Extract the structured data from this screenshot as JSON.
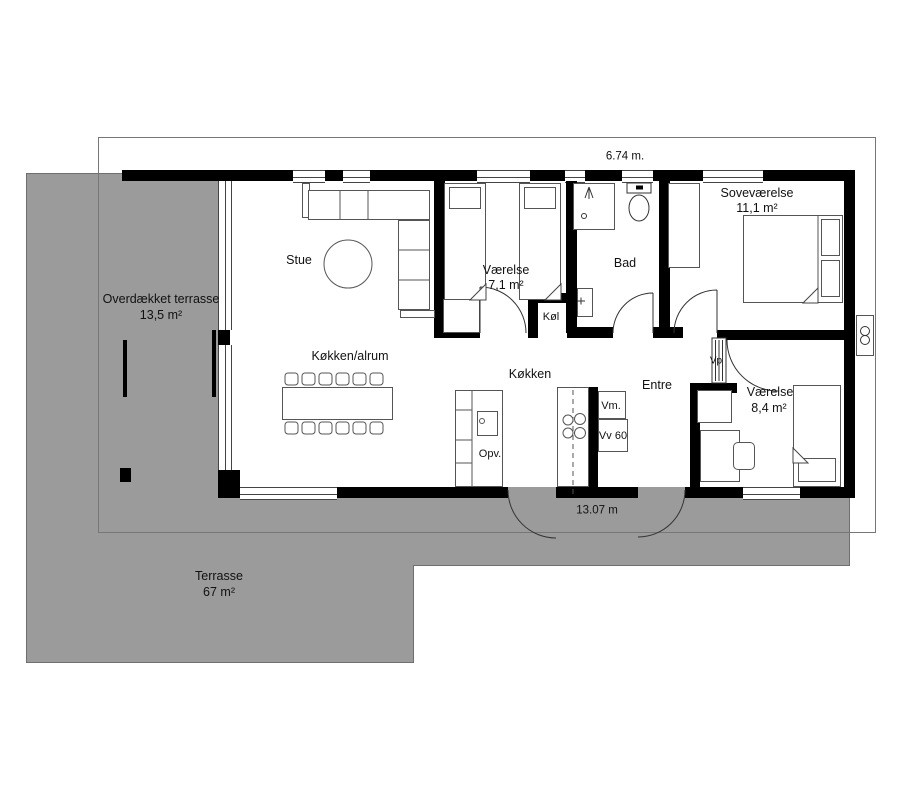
{
  "plan": {
    "title": "Floor plan",
    "rooms": {
      "stue": {
        "label": "Stue"
      },
      "koekken_alrum": {
        "label": "Køkken/alrum"
      },
      "koekken": {
        "label": "Køkken"
      },
      "vaerelse_71": {
        "label": "Værelse",
        "area": "7,1 m²"
      },
      "bad": {
        "label": "Bad"
      },
      "koel": {
        "label": "Køl"
      },
      "sovevaerelse": {
        "label": "Soveværelse",
        "area": "11,1 m²"
      },
      "entre": {
        "label": "Entre"
      },
      "vaerelse_84": {
        "label": "Værelse",
        "area": "8,4 m²"
      }
    },
    "outdoor": {
      "overdaekket_terrasse": {
        "label": "Overdækket terrasse",
        "area": "13,5 m²"
      },
      "terrasse": {
        "label": "Terrasse",
        "area": "67 m²"
      }
    },
    "fixtures": {
      "opvaskemaskine": "Opv.",
      "vaskemaskine": "Vm.",
      "varmtvandsbeholder": "Vv 60",
      "varmepumpe": "Vp"
    },
    "dimensions": {
      "top_width": "6.74 m.",
      "bottom_width": "13.07 m"
    },
    "colors": {
      "terrace_gray": "#9b9b9b",
      "wall_black": "#000000",
      "outline_gray": "#777777"
    }
  }
}
